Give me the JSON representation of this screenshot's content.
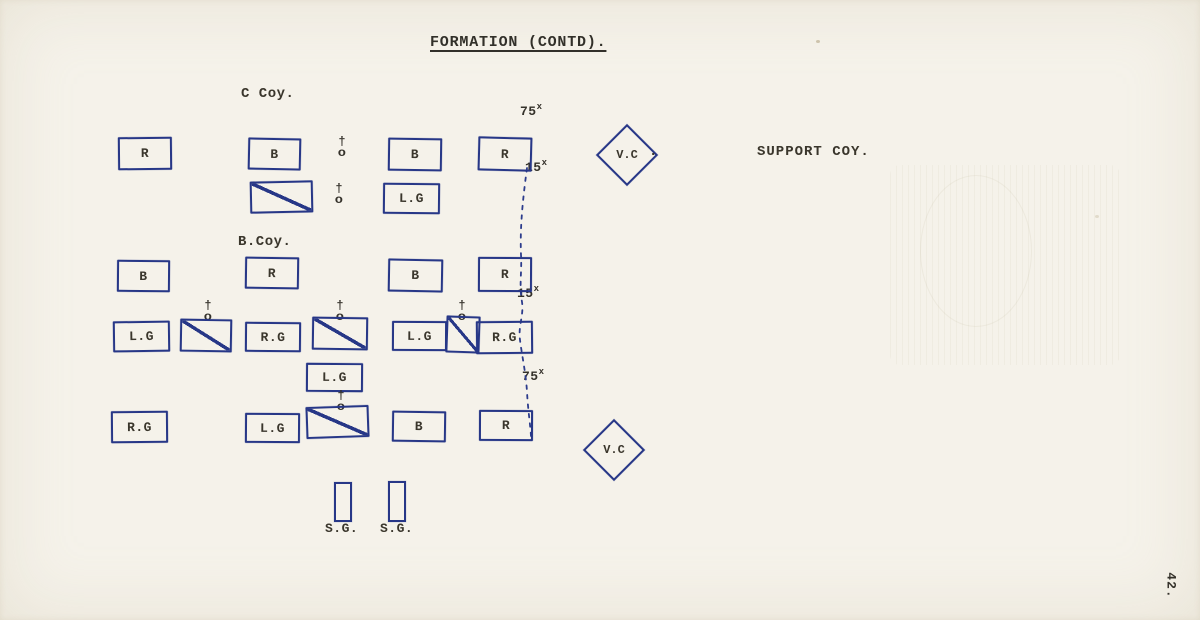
{
  "page": {
    "title": "FORMATION (CONTD).",
    "page_number": "42."
  },
  "section_labels": {
    "c_coy": "C Coy.",
    "b_coy": "B.Coy.",
    "support_coy": "SUPPORT COY."
  },
  "colors": {
    "ink_blue": "#273787",
    "typewriter_ink": "#3a362c",
    "paper": "#f5f2ea"
  },
  "symbols": {
    "officer_top": "†",
    "officer_bottom": "o"
  },
  "markers": {
    "top": "75",
    "upper": "15",
    "middle": "15",
    "lower": "75",
    "sup": "x"
  },
  "units": {
    "row1": [
      "R",
      "B",
      "B",
      "R"
    ],
    "row2_lg": "L.G",
    "row3": [
      "B",
      "R",
      "B",
      "R"
    ],
    "row4": [
      "L.G",
      "R.G",
      "L.G",
      "R.G"
    ],
    "mid_lg": "L.G",
    "row5": [
      "R.G",
      "L.G",
      "B",
      "R"
    ],
    "vc_top": "V.C",
    "vc_top_dot": ".",
    "vc_bottom": "V.C",
    "sg_left": "S.G.",
    "sg_right": "S.G."
  }
}
